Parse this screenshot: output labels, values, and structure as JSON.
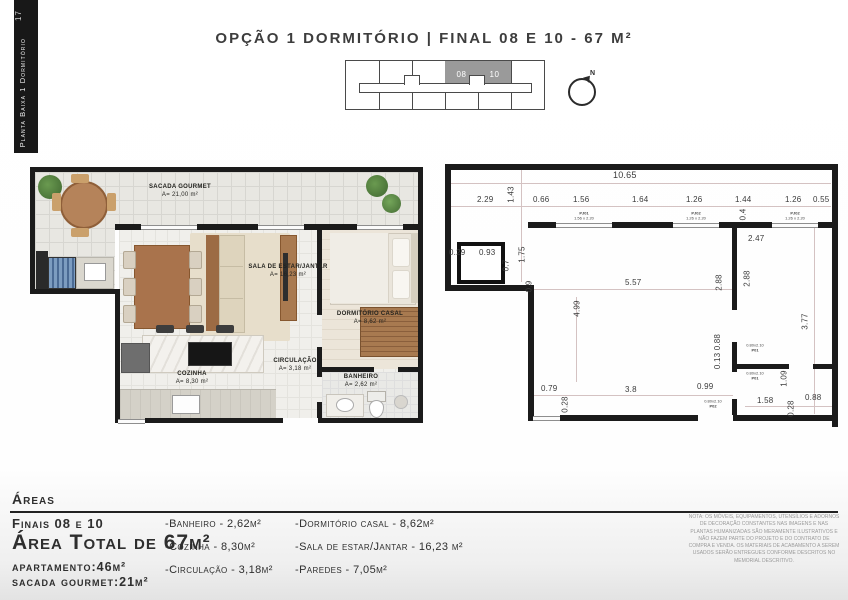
{
  "page": {
    "bg": "#ffffff"
  },
  "sidebar": {
    "page_number": "17",
    "label": "Planta Baixa 1 Dormitório"
  },
  "header": {
    "title": "OPÇÃO 1 DORMITÓRIO  |  FINAL 08 E 10 - 67 M²"
  },
  "key_plan": {
    "unit_a": "08",
    "unit_b": "10",
    "north": "N"
  },
  "floor_plan": {
    "rooms": [
      {
        "name": "SACADA GOURMET",
        "area": "A= 21,00 m²"
      },
      {
        "name": "SALA DE ESTAR/JANTAR",
        "area": "A= 16,23 m²"
      },
      {
        "name": "DORMITÓRIO CASAL",
        "area": "A= 8,62 m²"
      },
      {
        "name": "COZINHA",
        "area": "A= 8,30 m²"
      },
      {
        "name": "CIRCULAÇÃO",
        "area": "A= 3,18 m²"
      },
      {
        "name": "BANHEIRO",
        "area": "A= 2,62 m²"
      }
    ]
  },
  "tech_plan": {
    "dims": {
      "total": "10.65",
      "sacada_w": "2.29",
      "sacada_d": "1.43",
      "w1": "0.66",
      "w2": "1.56",
      "w3": "1.64",
      "w4": "1.26",
      "w5": "1.44",
      "w6": "1.26",
      "w7": "0.55",
      "wall_t": "0.4",
      "shaft_a": "0.29",
      "shaft_b": "0.93",
      "shaft_c": "0.7",
      "shaft_d": "1.75",
      "left_e": "0.9",
      "living_w": "5.57",
      "living_h": "4.99",
      "bed_w": "2.47",
      "bed_h1": "2.88",
      "bed_h2": "2.88",
      "bath_h": "3.77",
      "door_v": "0.13 0.88",
      "c1": "0.79",
      "c2": "0.28",
      "c3": "3.8",
      "c4": "0.99",
      "c5": "1.58",
      "c6": "1.09",
      "c7": "0.28",
      "c8": "0.88"
    },
    "windows": [
      {
        "code": "PJ01",
        "size": "1.56 x 2.20"
      },
      {
        "code": "PJ02",
        "size": "1.26 x 2.20"
      },
      {
        "code": "PJ02",
        "size": "1.26 x 2.20"
      }
    ],
    "doors": [
      {
        "code": "P01",
        "size": "0.80x2.10"
      },
      {
        "code": "P01",
        "size": "0.80x2.10"
      },
      {
        "code": "P02",
        "size": "0.80x2.10"
      }
    ]
  },
  "areas": {
    "heading": "Áreas",
    "finals": "Finais 08 e 10",
    "total": "Área Total de 67m²",
    "apartment": "apartamento:46m²",
    "sacada": "sacada gourmet:21m²",
    "col1": [
      "-Banheiro - 2,62m²",
      "-Cozinha - 8,30m²",
      "-Circulação - 3,18m²"
    ],
    "col2": [
      "-Dormitório casal - 8,62m²",
      "-Sala de estar/Jantar - 16,23 m²",
      "-Paredes - 7,05m²"
    ]
  },
  "note": "NOTA: OS MÓVEIS, EQUIPAMENTOS, UTENSÍLIOS E ADORNOS DE DECORAÇÃO CONSTANTES NAS IMAGENS E NAS PLANTAS HUMANIZADAS SÃO MERAMENTE ILUSTRATIVOS E NÃO FAZEM PARTE DO PROJETO E DO CONTRATO DE COMPRA E VENDA. OS MATERIAIS DE ACABAMENTO A SEREM USADOS SERÃO ENTREGUES CONFORME DESCRITOS NO MEMORIAL DESCRITIVO.",
  "colors": {
    "wall": "#1b1b1b",
    "highlight_cell": "#9a9a9a",
    "wood": "#a9734c"
  }
}
